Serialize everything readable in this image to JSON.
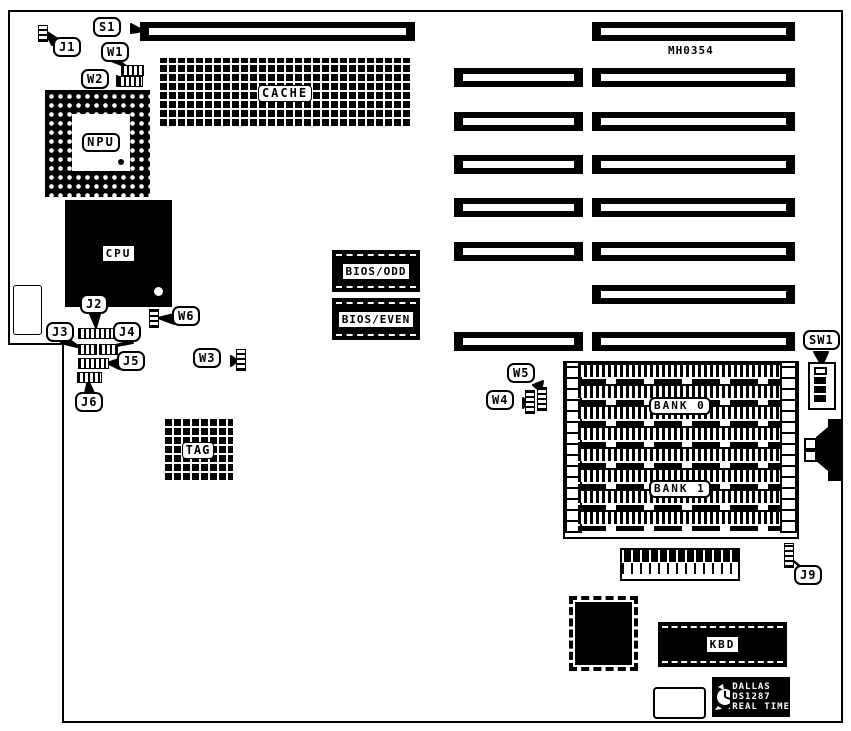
{
  "figure": {
    "type": "motherboard layout diagram",
    "board_id": "MH0354"
  },
  "labels": {
    "s1": "S1",
    "j1": "J1",
    "w1": "W1",
    "w2": "W2",
    "npu": "NPU",
    "cache": "CACHE",
    "cpu": "CPU",
    "bios_odd": "BIOS/ODD",
    "bios_even": "BIOS/EVEN",
    "j2": "J2",
    "j3": "J3",
    "j4": "J4",
    "j5": "J5",
    "j6": "J6",
    "w3": "W3",
    "w6": "W6",
    "w4": "W4",
    "w5": "W5",
    "tag": "TAG",
    "bank0": "BANK 0",
    "bank1": "BANK 1",
    "sw1": "SW1",
    "j9": "J9",
    "kbd": "KBD",
    "rtc_brand": "DALLAS",
    "rtc_model": "DS1287",
    "rtc_type": "REAL TIME"
  },
  "colors": {
    "ink": "#000000",
    "paper": "#ffffff"
  }
}
